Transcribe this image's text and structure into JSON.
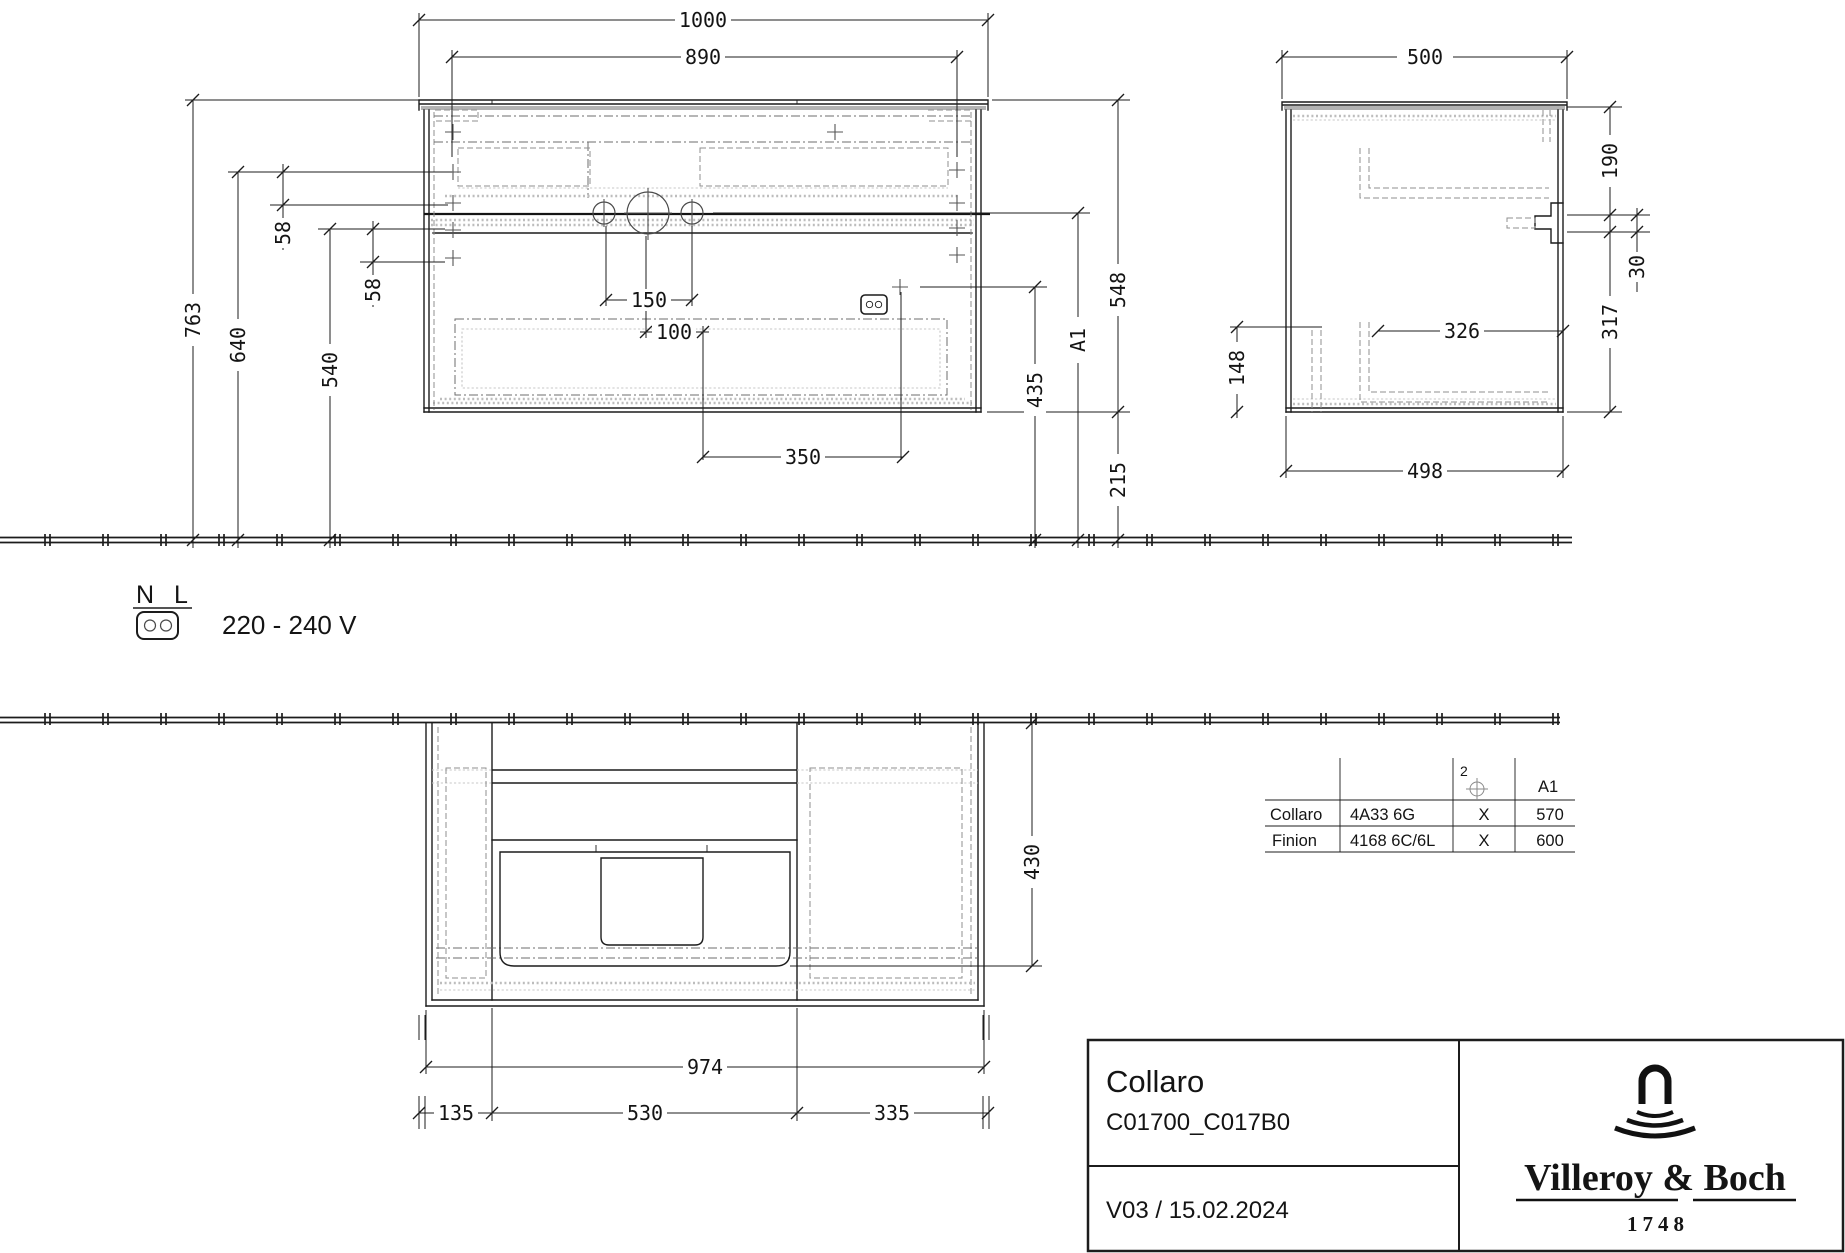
{
  "front": {
    "d1000": "1000",
    "d890": "890",
    "d150": "150",
    "d100": "100",
    "d350": "350",
    "d763": "763",
    "d640": "640",
    "d540": "540",
    "d58a": "58",
    "d58b": "58",
    "d548": "548",
    "dA1": "A1",
    "d435": "435",
    "d215": "215"
  },
  "side": {
    "d500": "500",
    "d190": "190",
    "d30": "30",
    "d317": "317",
    "d148": "148",
    "d326": "326",
    "d498": "498"
  },
  "plan": {
    "d974": "974",
    "d135": "135",
    "d530": "530",
    "d335": "335",
    "d430": "430"
  },
  "power": {
    "n": "N",
    "l": "L",
    "voltage": "220 - 240 V"
  },
  "table": {
    "qty": "2",
    "col_a1": "A1",
    "rows": [
      {
        "name": "Collaro",
        "article": "4A33 6G",
        "mark": "X",
        "a1": "570"
      },
      {
        "name": "Finion",
        "article": "4168 6C/6L",
        "mark": "X",
        "a1": "600"
      }
    ]
  },
  "titleblock": {
    "product": "Collaro",
    "article": "C01700_C017B0",
    "version": "V03 / 15.02.2024",
    "brand": "Villeroy & Boch",
    "year": "1748"
  },
  "colors": {
    "line": "#1c1c1c",
    "hidden_line": "#8f8f8f",
    "shading": "#b3b3b3"
  }
}
